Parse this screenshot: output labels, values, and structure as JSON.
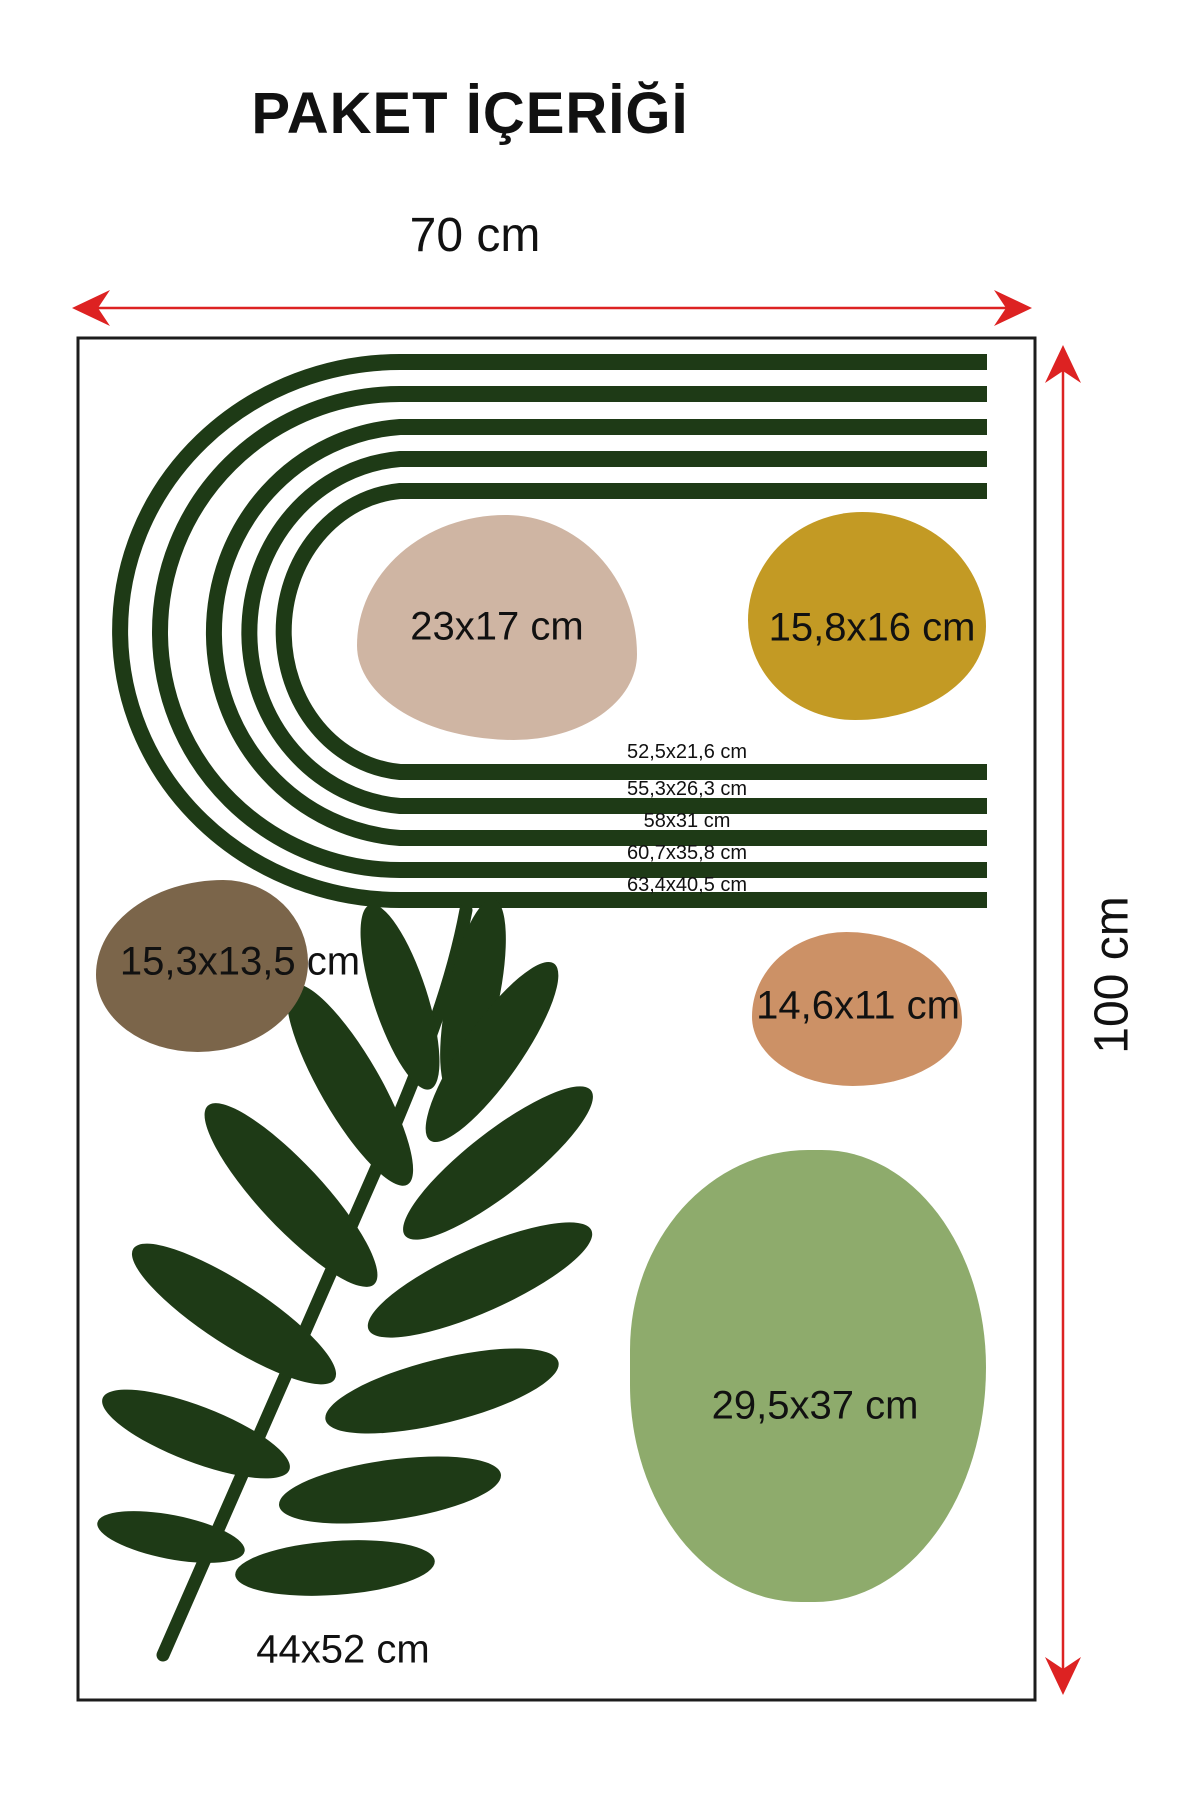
{
  "page": {
    "title": "PAKET İÇERİĞİ"
  },
  "dimensions": {
    "width": {
      "label": "70 cm"
    },
    "height": {
      "label": "100 cm"
    }
  },
  "colors": {
    "dark-green": "#1e3a16",
    "beige": "#cfb5a3",
    "mustard": "#c39a24",
    "brown": "#7b654a",
    "tan": "#cc9166",
    "light-green": "#8eab6c",
    "red": "#dd2222",
    "border": "#1c1c1c"
  },
  "rainbow": {
    "labels": [
      "52,5x21,6 cm",
      "55,3x26,3 cm",
      "58x31 cm",
      "60,7x35,8 cm",
      "63,4x40,5 cm"
    ]
  },
  "blobs": [
    {
      "name": "beige-blob",
      "label": "23x17 cm"
    },
    {
      "name": "mustard-blob",
      "label": "15,8x16 cm"
    },
    {
      "name": "brown-blob",
      "label": "15,3x13,5 cm"
    },
    {
      "name": "tan-blob",
      "label": "14,6x11 cm"
    },
    {
      "name": "green-blob",
      "label": "29,5x37 cm"
    }
  ],
  "leaf": {
    "label": "44x52 cm"
  }
}
